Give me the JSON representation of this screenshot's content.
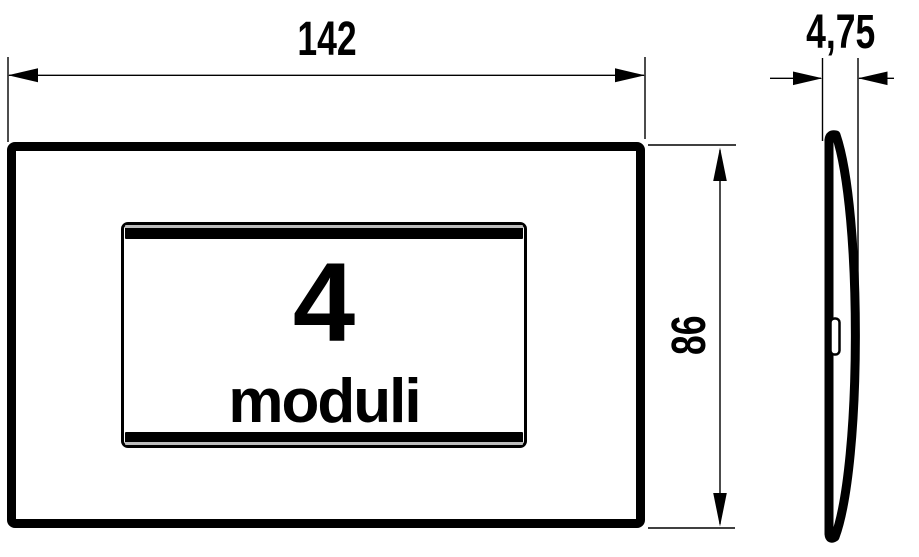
{
  "front_view": {
    "module_count": "4",
    "module_word": "moduli"
  },
  "dimensions": {
    "width_label": "142",
    "height_label": "86",
    "thickness_label": "4,75"
  },
  "style": {
    "line_color": "#000000",
    "background_color": "#ffffff",
    "rail_hairline_color": "#bdbdbd"
  }
}
